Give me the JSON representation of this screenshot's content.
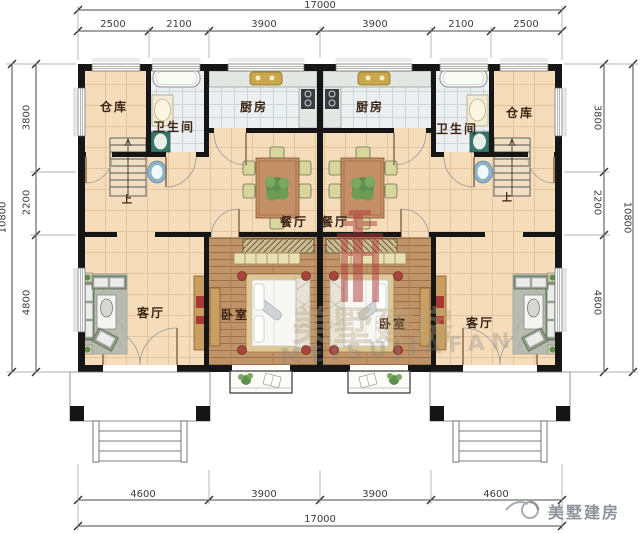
{
  "plan": {
    "dimensions": {
      "top": {
        "total": "17000",
        "segments": [
          "2500",
          "2100",
          "3900",
          "3900",
          "2100",
          "2500"
        ]
      },
      "bottom": {
        "total": "17000",
        "segments": [
          "4600",
          "3900",
          "3900",
          "4600"
        ]
      },
      "left": {
        "total": "10800",
        "segments": [
          "3800",
          "2200",
          "4800"
        ]
      },
      "right": {
        "total": "10800",
        "segments": [
          "3800",
          "2200",
          "4800"
        ]
      }
    },
    "rooms": {
      "left_unit": {
        "storage": "仓库",
        "bathroom": "卫生间",
        "kitchen": "厨房",
        "dining": "餐厅",
        "living": "客厅",
        "bedroom": "卧室",
        "stairs_up": "上"
      },
      "right_unit": {
        "storage": "仓库",
        "bathroom": "卫生间",
        "kitchen": "厨房",
        "dining": "餐厅",
        "living": "客厅",
        "bedroom": "卧室",
        "stairs_up": "上"
      }
    }
  },
  "watermark": {
    "latin": "MEISUJIAFAN",
    "cjk": "美墅建房",
    "logo_color": "#b23b3b"
  },
  "branding": {
    "name": "美墅建房"
  },
  "colors": {
    "wall": "#161616",
    "floor_tile": "#f5ddbb",
    "wet_tile": "#eceff0",
    "wood_floor": "#c09468",
    "dim_line": "#4a4a4a"
  }
}
